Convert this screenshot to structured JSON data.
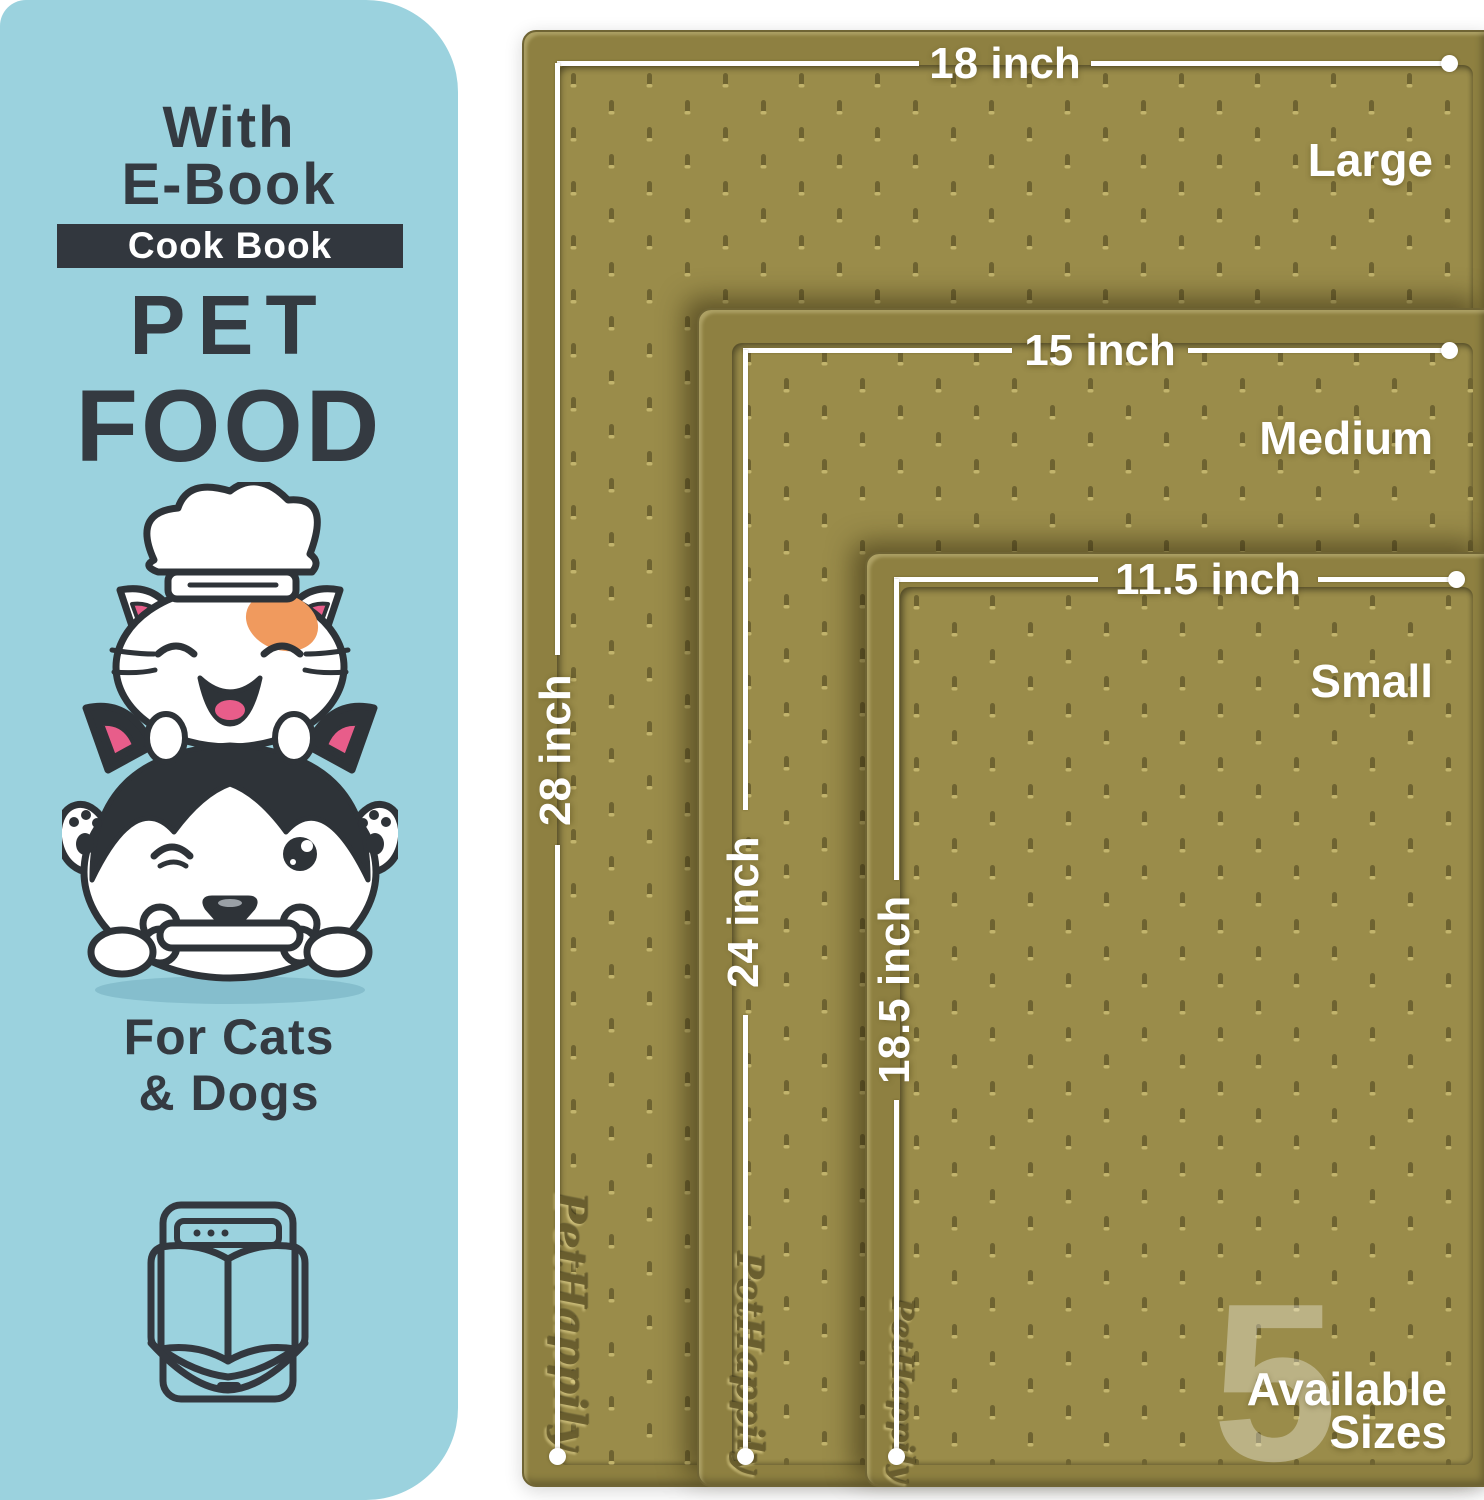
{
  "panel": {
    "heading_line1": "With",
    "heading_line2": "E-Book",
    "badge": "Cook Book",
    "title_line1": "PET",
    "title_line2": "FOOD",
    "subtitle_line1": "For Cats",
    "subtitle_line2": "& Dogs",
    "illustration": "cat-chef-and-husky-with-bone",
    "icon": "ebook-reader-icon",
    "colors": {
      "panel_bg": "#9bd2de",
      "ink": "#343a41",
      "badge_bg": "#32373e",
      "badge_text": "#ffffff",
      "patch_orange": "#f09a5e",
      "pink": "#e85d8a"
    }
  },
  "mats": {
    "brand_emboss": "PetHappily",
    "colors": {
      "surface": "#9a8c4a",
      "rim": "#8e8041",
      "dash": "#6e6331",
      "measure_line": "#ffffff"
    },
    "items": [
      {
        "size_label": "Large",
        "width_label": "18 inch",
        "height_label": "28 inch"
      },
      {
        "size_label": "Medium",
        "width_label": "15 inch",
        "height_label": "24 inch"
      },
      {
        "size_label": "Small",
        "width_label": "11.5 inch",
        "height_label": "18.5 inch"
      }
    ],
    "badge": {
      "number": "5",
      "caption_line1": "Available",
      "caption_line2": "Sizes"
    }
  }
}
